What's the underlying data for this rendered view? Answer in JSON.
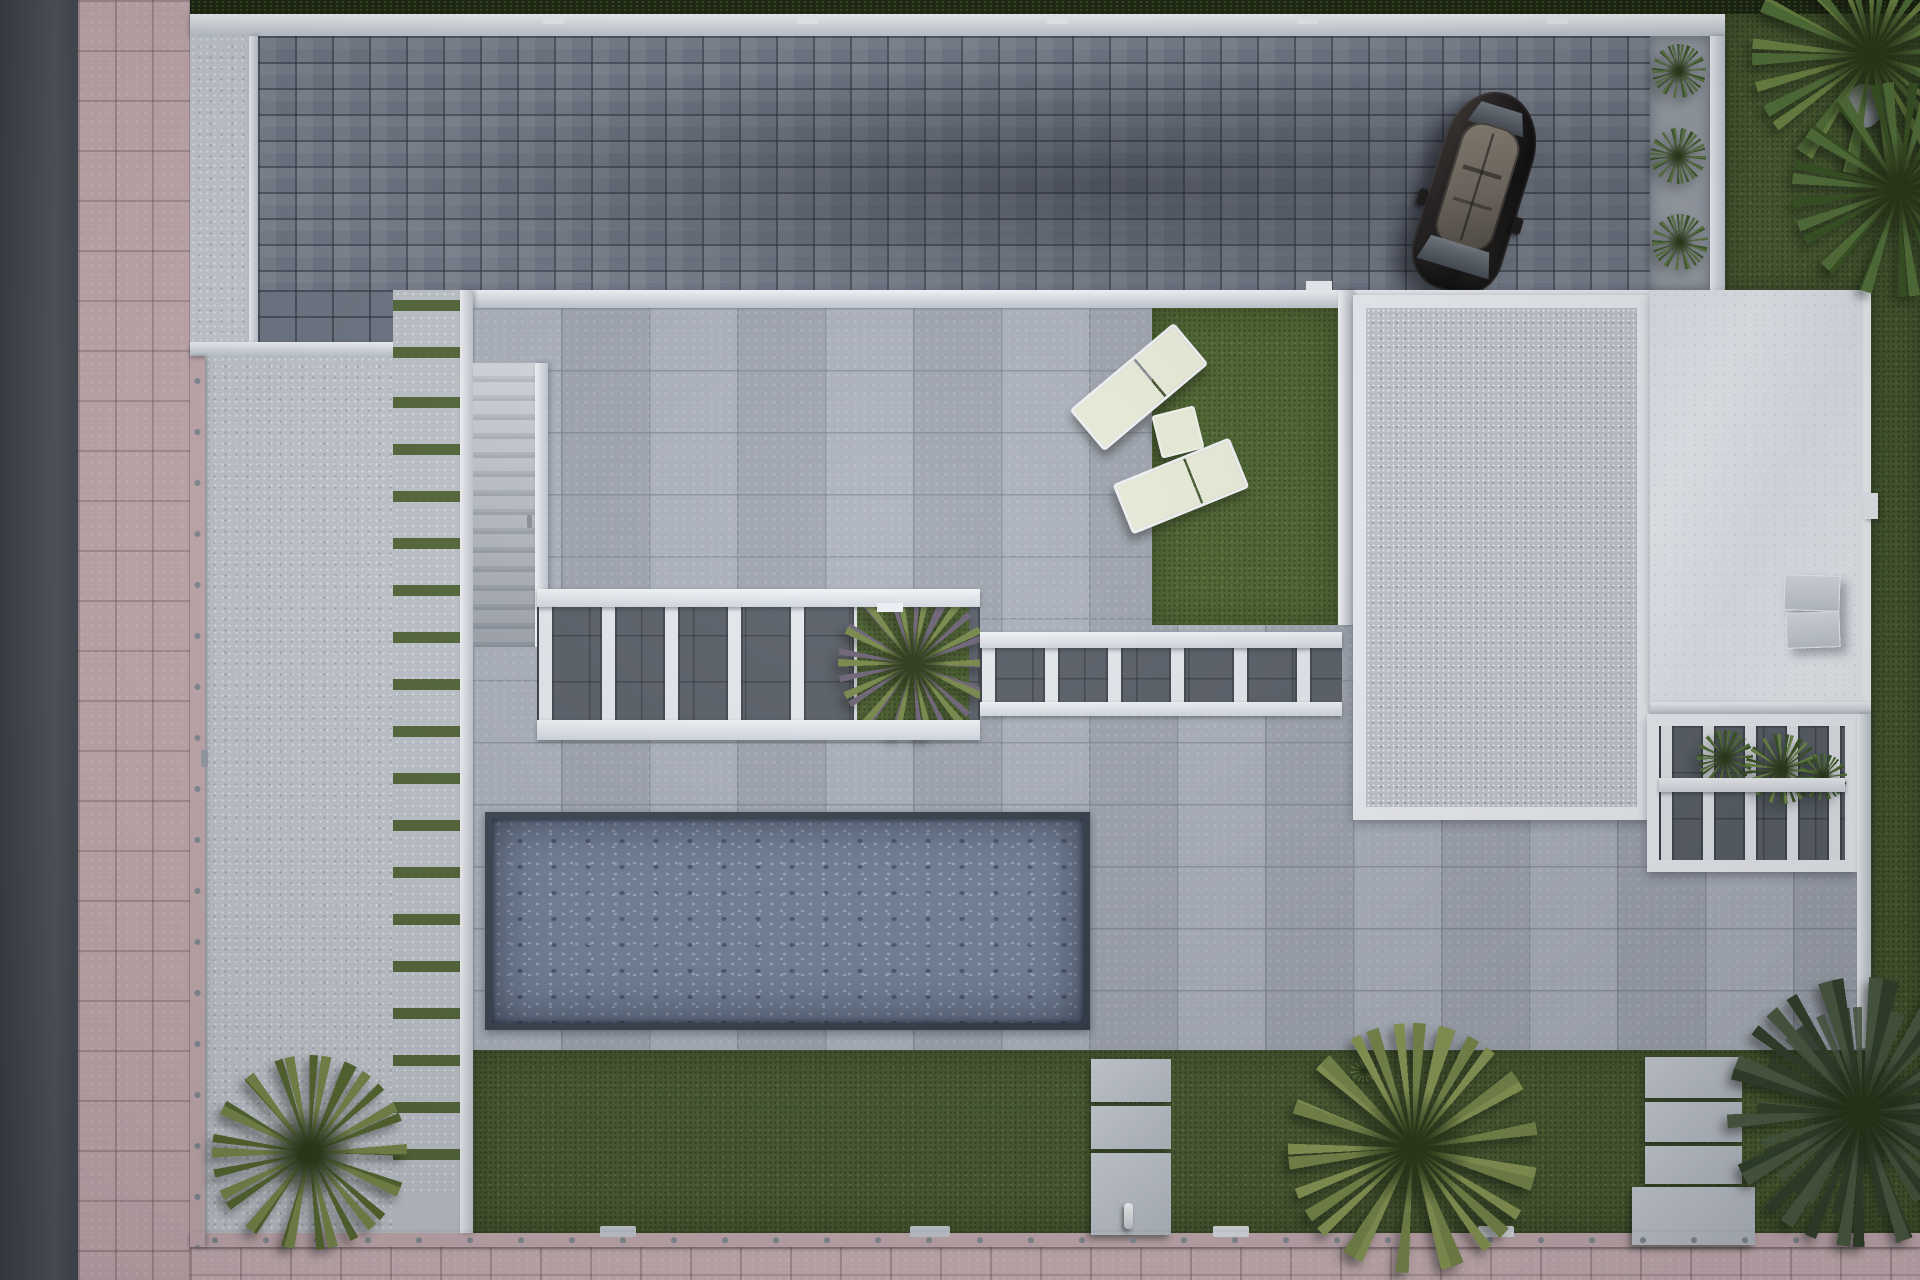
{
  "meta": {
    "title": "Top-down 3D architectural render of a modern villa plot",
    "view": "aerial / plan view",
    "visible_text": "none"
  },
  "colors": {
    "road": "#50555e",
    "road_dark": "#3a3f47",
    "sidewalk": "#c7aeb2",
    "hedge": "#1b250f",
    "wall_white": "#eef1f6",
    "wall_bright": "#f6f8fb",
    "wall_shade": "#c2c9d2",
    "dot_fixing": "#878d96",
    "drive_paver": "#6f7684",
    "entry_concrete": "#c9cdd4",
    "courtyard_concrete": "#c4c9d0",
    "walkway_concrete": "#c2c7ce",
    "stair_tread": "#ced3da",
    "stair_riser": "#aeb4bd",
    "joint_grass": "#55683a",
    "terrace_paver": "#a9afba",
    "gravel_roof": "#c3c8d0",
    "white_roof": "#edf0f5",
    "pergola_dark": "#5a6069",
    "slat_white": "#e7ebf0",
    "pool_rim": "#323b47",
    "pool_water": "#74829a",
    "lawn": "#4a5d31",
    "patch_grass": "#4e6530",
    "cream": "#edefdc",
    "lounger_frame": "#f3f5f7",
    "car_body": "#242020",
    "car_roof": "#8a8174",
    "ac_unit": "#dde2e8",
    "gravel_strip": "#9ba1aa",
    "palm_olive": "#79894a",
    "palm_olive_dark": "#57682f",
    "palm_green": "#55743a",
    "palm_green_dark": "#3a5524",
    "tree_leaf": "#4c5c43",
    "tree_leaf_dark": "#33422c",
    "agave": "#5a7542",
    "agave_dark": "#3f5a2c"
  },
  "objects": [
    {
      "name": "street-road",
      "note": "dark asphalt strip along left edge"
    },
    {
      "name": "pink-paver-sidewalk",
      "note": "wraps left and bottom edges"
    },
    {
      "name": "boundary-hedge",
      "note": "dark green strip along top edge"
    },
    {
      "name": "perimeter-wall",
      "note": "white wall with fixing dots around plot"
    },
    {
      "name": "paver-driveway",
      "note": "slate block paving, top of plot"
    },
    {
      "name": "parked-suv",
      "note": "dark SUV with panoramic roof, angled on driveway"
    },
    {
      "name": "planting-strip-agaves",
      "note": "three agave plants right of driveway"
    },
    {
      "name": "stepping-walkway",
      "note": "concrete strip with grass joints, left side"
    },
    {
      "name": "outdoor-staircase",
      "note": "stairs beside walkway"
    },
    {
      "name": "inner-courtyard",
      "note": "speckled concrete court, left side"
    },
    {
      "name": "terrace",
      "note": "large grey porcelain pavers around house"
    },
    {
      "name": "sun-loungers",
      "note": "two cream loungers with side table on turf patch"
    },
    {
      "name": "pergola-slatted-walk",
      "note": "two white slatted canopies over dark paving"
    },
    {
      "name": "planter-in-pergola",
      "note": "tropical plant in canopy opening"
    },
    {
      "name": "gravel-flat-roof",
      "note": "white-bordered gravel roof section"
    },
    {
      "name": "white-flat-roof",
      "note": "smooth white roof with two AC units"
    },
    {
      "name": "rear-pergola",
      "note": "slatted canopy with plants, right side"
    },
    {
      "name": "swimming-pool",
      "note": "rectangular pool with rippled water"
    },
    {
      "name": "back-lawn",
      "note": "turf band along bottom with stepping stones"
    },
    {
      "name": "palm-trees",
      "note": "two top-right, one bottom-centre, one bottom-left"
    },
    {
      "name": "shade-tree",
      "note": "large dark tree, bottom-right corner"
    },
    {
      "name": "rock",
      "note": "decorative boulder among top-right palms"
    }
  ]
}
